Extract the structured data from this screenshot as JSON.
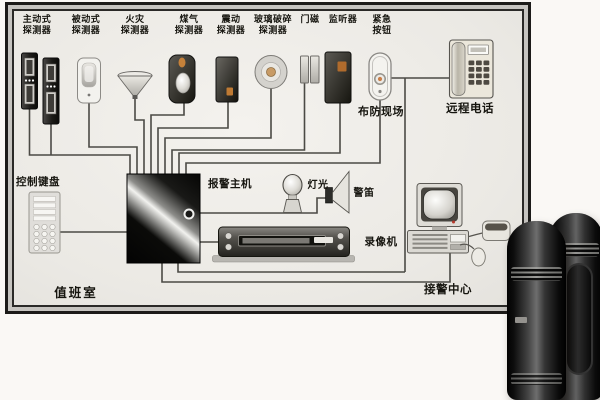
{
  "diagram": {
    "type": "security-alarm-system-wiring-diagram",
    "detectors": [
      {
        "id": "active",
        "line1": "主动式",
        "line2": "探测器"
      },
      {
        "id": "passive",
        "line1": "被动式",
        "line2": "探测器"
      },
      {
        "id": "fire",
        "line1": "火灾",
        "line2": "探测器"
      },
      {
        "id": "gas",
        "line1": "煤气",
        "line2": "探测器"
      },
      {
        "id": "vibration",
        "line1": "震动",
        "line2": "探测器"
      },
      {
        "id": "glass-break",
        "line1": "玻璃破碎",
        "line2": "探测器"
      },
      {
        "id": "door-magnet",
        "line1": "门磁",
        "line2": ""
      },
      {
        "id": "listener",
        "line1": "监听器",
        "line2": ""
      },
      {
        "id": "emergency-button",
        "line1": "紧急",
        "line2": "按钮"
      }
    ],
    "nodes": {
      "armed_site": "布防现场",
      "remote_phone": "远程电话",
      "control_keypad": "控制键盘",
      "alarm_host": "报警主机",
      "light": "灯光",
      "siren": "警笛",
      "vcr": "录像机",
      "alarm_center": "接警中心",
      "duty_room": "值班室"
    },
    "icons": [
      "beam-tower-detector-icon",
      "pir-detector-icon",
      "smoke-detector-icon",
      "gas-detector-icon",
      "vibration-detector-icon",
      "glass-break-detector-icon",
      "door-contact-icon",
      "listener-icon",
      "panic-button-icon",
      "telephone-icon",
      "keypad-icon",
      "alarm-panel-icon",
      "lamp-icon",
      "horn-siren-icon",
      "vcr-icon",
      "computer-icon",
      "mouse-icon",
      "modem-icon",
      "ir-beam-tower-photo"
    ],
    "colors": {
      "page_bg": "#faf8f5",
      "frame_dark": "#1c1b19",
      "frame_gray": "#c6c4c0",
      "canvas": "#f1efea",
      "wire": "#4b4a45",
      "label_text": "#16150f",
      "accent_orange": "#c07a35",
      "host_black": "#0a0a0a"
    }
  }
}
